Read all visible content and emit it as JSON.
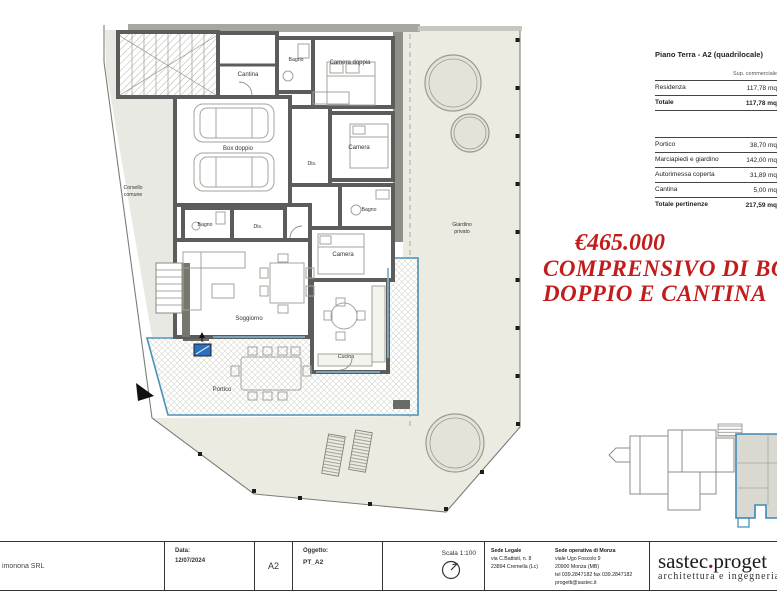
{
  "plan": {
    "labels": {
      "cantina": "Cantina",
      "bagno_top": "Bagno",
      "camera_doppia": "Camera doppia",
      "box_doppio": "Box doppio",
      "camera_right": "Camera",
      "dis_right": "Dis.",
      "bagno_right": "Bagno",
      "bagno_mid": "Bagno",
      "dis_mid": "Dis.",
      "camera_low": "Camera",
      "soggiorno": "Soggiorno",
      "cucina": "Cucina",
      "portico": "Portico",
      "giardino_line1": "Giardino",
      "giardino_line2": "privato",
      "corsello_line1": "Corsello",
      "corsello_line2": "comune"
    },
    "accent_blue": "#4a90b8"
  },
  "price": {
    "line1": "€465.000",
    "line2": "COMPRENSIVO DI BOX",
    "line3": "DOPPIO E CANTINA",
    "color": "#c21d1d"
  },
  "table": {
    "title": "Piano Terra - A2 (quadrilocale)",
    "col_header": "Sup. commerciale",
    "rows": [
      {
        "label": "Residenza",
        "value": "117,78 mq"
      },
      {
        "label": "Totale",
        "value": "117,78 mq"
      },
      {
        "label": "Portico",
        "value": "38,70 mq"
      },
      {
        "label": "Marciapiedi e giardino",
        "value": "142,00 mq"
      },
      {
        "label": "Autorimessa coperta",
        "value": "31,89 mq"
      },
      {
        "label": "Cantina",
        "value": "5,00 mq"
      },
      {
        "label": "Totale pertinenze",
        "value": "217,59 mq"
      }
    ]
  },
  "titleblock": {
    "client": "imonona SRL",
    "date_label": "Data:",
    "date": "12/07/2024",
    "sheet": "A2",
    "object_label": "Oggetto:",
    "object": "PT_A2",
    "scale_label": "Scala 1:100",
    "sede_legale_title": "Sede Legale",
    "sede_legale_line1": "via C.Battisti, n. 8",
    "sede_legale_line2": "23894 Cremella (Lc)",
    "sede_operativa_title": "Sede operativa di Monza",
    "sede_operativa_line1": "viale Ugo Foscolo 9",
    "sede_operativa_line2": "20900 Monza (MB)",
    "sede_operativa_line3": "tel 039.2847182   fax 039.2847182",
    "sede_operativa_line4": "progetti@sastec.it",
    "logo_part1": "sastec",
    "logo_dot": ".",
    "logo_part2": "proget",
    "logo_tagline": "architettura e ingegneria"
  }
}
